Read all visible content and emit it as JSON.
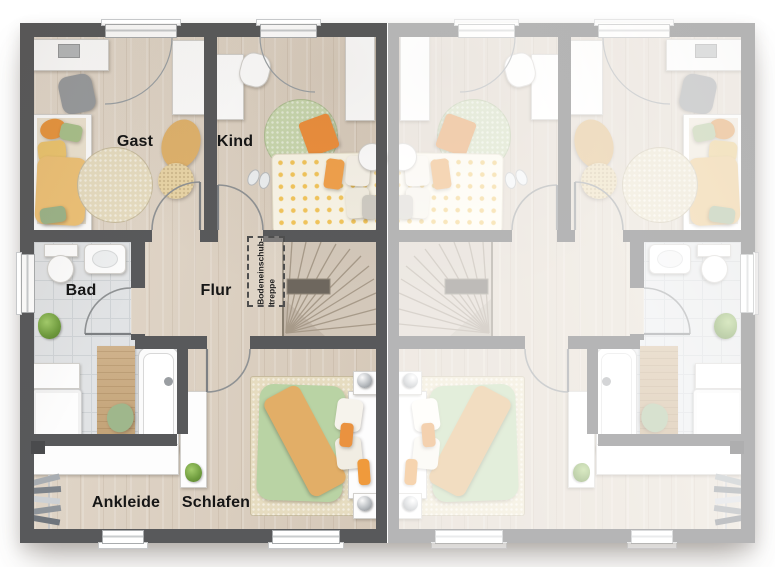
{
  "labels": {
    "gast": "Gast",
    "kind": "Kind",
    "bad": "Bad",
    "flur": "Flur",
    "ankleide": "Ankleide",
    "schlafen": "Schlafen",
    "attic_hatch_line1": "Bodeneinschub-",
    "attic_hatch_line2": "treppe"
  },
  "colors": {
    "background": "#ffffff",
    "wall_dark": "#58595b",
    "wall_mirrored_faded": "#b9babb",
    "floor_wood": "#dcd1c3",
    "floor_tile": "#e1e3e5",
    "stair_tread": "#d3c8ba",
    "accent_orange": "#e8913f",
    "accent_peach": "#eec277",
    "accent_green": "#b9d3a4",
    "rug_beige": "#e6dcc0",
    "rug_green": "#c9d8af",
    "label_text": "#161616"
  }
}
